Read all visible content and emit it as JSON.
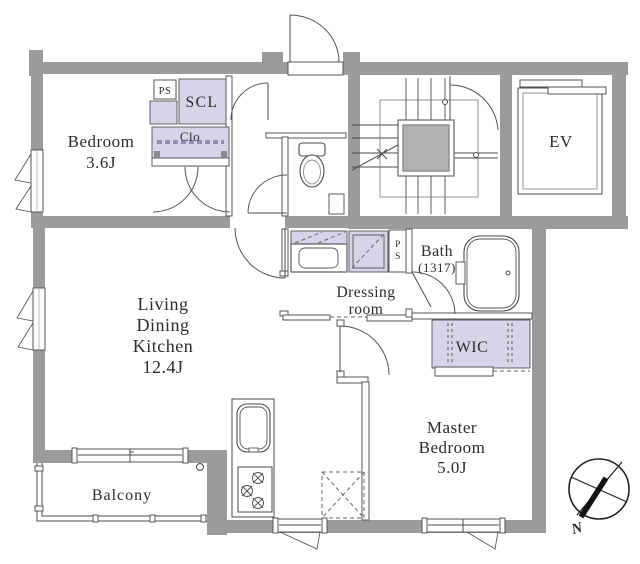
{
  "colors": {
    "wall": "#9b9b9b",
    "closet": "#d7d3e8",
    "staircore": "#b1b1b1",
    "line": "#4b4b4b",
    "text": "#2b2b2b",
    "bg": "#ffffff"
  },
  "rooms": {
    "bedroom": {
      "name": "Bedroom",
      "size": "3.6J"
    },
    "ldk": {
      "line1": "Living",
      "line2": "Dining",
      "line3": "Kitchen",
      "size": "12.4J"
    },
    "master": {
      "line1": "Master",
      "line2": "Bedroom",
      "size": "5.0J"
    },
    "dressing": {
      "line1": "Dressing",
      "line2": "room"
    },
    "bath": {
      "name": "Bath",
      "size": "(1317)"
    },
    "balcony": {
      "name": "Balcony"
    },
    "wic": {
      "name": "WIC"
    },
    "scl": {
      "name": "SCL"
    },
    "clo": {
      "name": "Clo"
    },
    "ev": {
      "name": "EV"
    },
    "ps_top": {
      "name": "PS"
    },
    "ps_bath": {
      "p": "P",
      "s": "S"
    },
    "compass": {
      "north": "N"
    }
  },
  "fixtures": [
    "toilet",
    "bathtub",
    "washbasin",
    "washing-machine",
    "kitchen-sink",
    "gas-stove",
    "refrigerator-space",
    "staircase",
    "elevator",
    "compass"
  ]
}
